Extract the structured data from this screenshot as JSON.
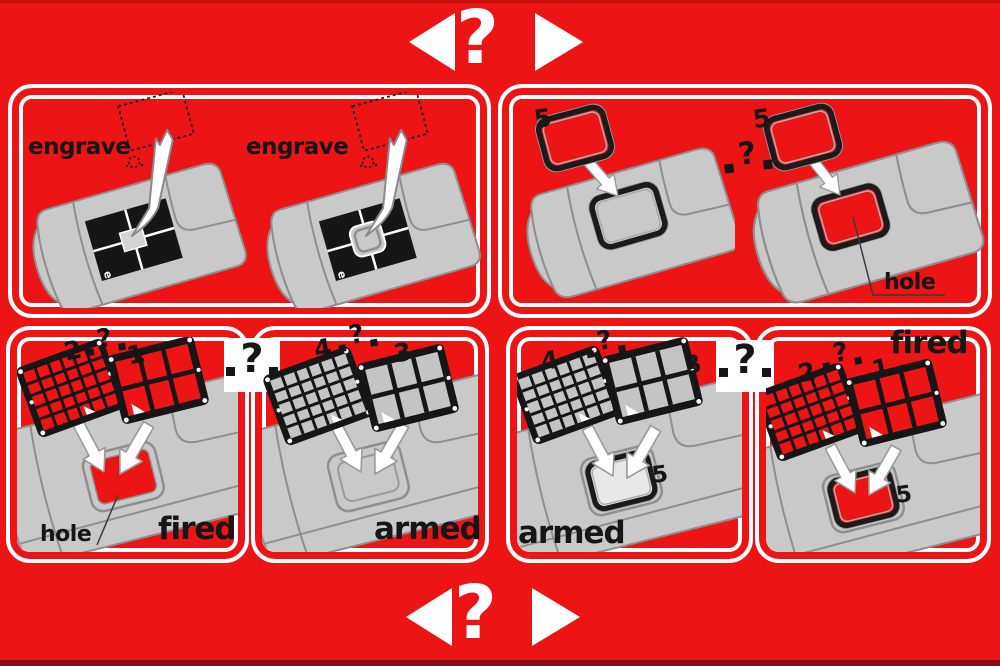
{
  "colors": {
    "background_red": "#EC1414",
    "panel_gray": "#C9C9C9",
    "line_gray": "#8F8F8F",
    "ink_black": "#161616",
    "white": "#FFFFFF"
  },
  "nav_top": {
    "question": "?"
  },
  "nav_bottom": {
    "question": "?"
  },
  "engrave_panel": {
    "left": {
      "label": "engrave",
      "corner_mark": "e"
    },
    "right": {
      "label": "engrave",
      "corner_mark": "e"
    }
  },
  "frame_panel": {
    "left": {
      "part_number": "5"
    },
    "divider_question": "?",
    "right": {
      "part_number": "5",
      "hole_label": "hole"
    }
  },
  "bottom_left": {
    "fired": {
      "part_left": "2",
      "question": "?",
      "part_right": "1",
      "hole_label": "hole",
      "state": "fired"
    },
    "badge_question": "?",
    "armed": {
      "part_left": "4",
      "question": "?",
      "part_right": "3",
      "state": "armed"
    }
  },
  "bottom_right": {
    "armed": {
      "part_left": "4",
      "question": "?",
      "part_right": "3",
      "frame_part": "5",
      "state": "armed"
    },
    "badge_question": "?",
    "fired": {
      "part_left": "2",
      "question": "?",
      "part_right": "1",
      "frame_part": "5",
      "state": "fired"
    }
  }
}
